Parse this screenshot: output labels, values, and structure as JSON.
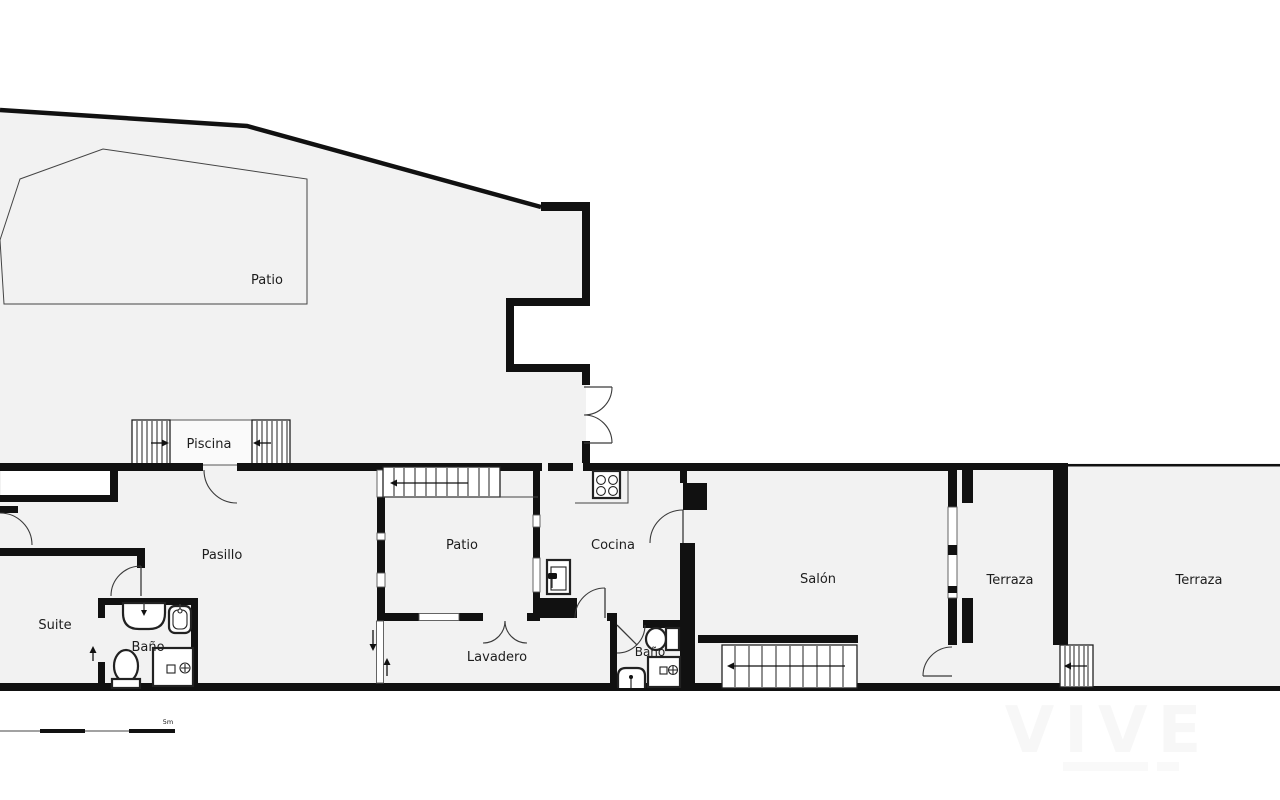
{
  "title": "Floor plan",
  "rooms": {
    "patio_top": "Patio",
    "piscina": "Piscina",
    "pasillo": "Pasillo",
    "patio_inner": "Patio",
    "cocina": "Cocina",
    "salon": "Salón",
    "terraza_1": "Terraza",
    "terraza_2": "Terraza",
    "suite": "Suite",
    "bano_1": "Baño",
    "lavadero": "Lavadero",
    "bano_2": "Baño"
  },
  "scale": {
    "label": "5m"
  },
  "watermark": {
    "text": "VIVE"
  },
  "icons": {
    "stove": "stove-icon",
    "kitchen_sink": "sink-icon",
    "bathroom_sink": "sink-icon",
    "toilet": "toilet-icon",
    "shower": "shower-icon",
    "stairs": "stairs-icon",
    "pool": "pool-icon"
  },
  "colors": {
    "wall": "#111111",
    "room_fill": "#f2f2f2",
    "label": "#1d1d1d",
    "watermark": "#f7f7f7"
  }
}
